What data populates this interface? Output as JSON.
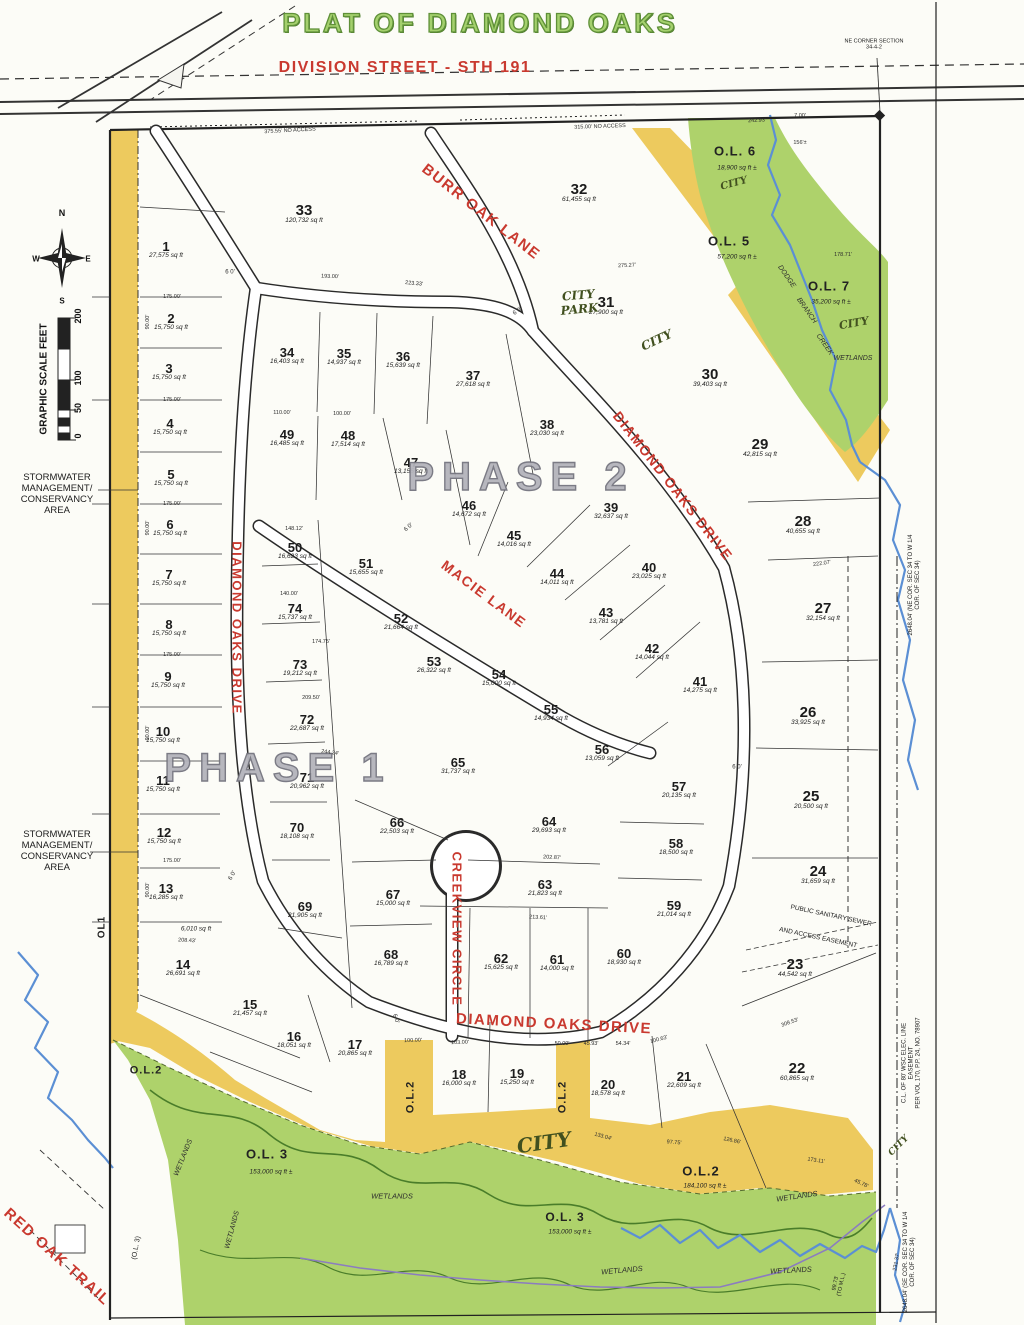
{
  "title": "PLAT OF DIAMOND OAKS",
  "colors": {
    "road_band_yellow": "#edca5e",
    "wetland_green": "#aed26b",
    "street_red": "#c9392f",
    "title_green": "#a4d06d",
    "creek_blue": "#5b8fd4",
    "easement_purple": "#8b7cc0",
    "phase_gray": "#9a9aa2"
  },
  "lots": [
    {
      "n": "1",
      "sf": "27,575 sq ft",
      "x": 166,
      "y": 250
    },
    {
      "n": "2",
      "sf": "15,750 sq ft",
      "x": 171,
      "y": 322
    },
    {
      "n": "3",
      "sf": "15,750 sq ft",
      "x": 169,
      "y": 372
    },
    {
      "n": "4",
      "sf": "15,750 sq ft",
      "x": 170,
      "y": 427
    },
    {
      "n": "5",
      "sf": "15,750 sq ft",
      "x": 171,
      "y": 478
    },
    {
      "n": "6",
      "sf": "15,750 sq ft",
      "x": 170,
      "y": 528
    },
    {
      "n": "7",
      "sf": "15,750 sq ft",
      "x": 169,
      "y": 578
    },
    {
      "n": "8",
      "sf": "15,750 sq ft",
      "x": 169,
      "y": 628
    },
    {
      "n": "9",
      "sf": "15,750 sq ft",
      "x": 168,
      "y": 680
    },
    {
      "n": "10",
      "sf": "15,750 sq ft",
      "x": 163,
      "y": 735
    },
    {
      "n": "11",
      "sf": "15,750 sq ft",
      "x": 163,
      "y": 784
    },
    {
      "n": "12",
      "sf": "15,750 sq ft",
      "x": 164,
      "y": 836
    },
    {
      "n": "13",
      "sf": "16,285 sq ft",
      "x": 166,
      "y": 892
    },
    {
      "n": "14",
      "sf": "26,691 sq ft",
      "x": 183,
      "y": 968
    },
    {
      "n": "15",
      "sf": "21,457 sq ft",
      "x": 250,
      "y": 1008
    },
    {
      "n": "16",
      "sf": "18,051 sq ft",
      "x": 294,
      "y": 1040
    },
    {
      "n": "17",
      "sf": "20,865 sq ft",
      "x": 355,
      "y": 1048
    },
    {
      "n": "18",
      "sf": "16,000 sq ft",
      "x": 459,
      "y": 1078
    },
    {
      "n": "19",
      "sf": "15,250 sq ft",
      "x": 517,
      "y": 1077
    },
    {
      "n": "20",
      "sf": "18,578 sq ft",
      "x": 608,
      "y": 1088
    },
    {
      "n": "21",
      "sf": "22,609 sq ft",
      "x": 684,
      "y": 1080
    },
    {
      "n": "22",
      "sf": "60,865 sq ft",
      "x": 797,
      "y": 1072,
      "b": 1
    },
    {
      "n": "23",
      "sf": "44,542 sq ft",
      "x": 795,
      "y": 968,
      "b": 1
    },
    {
      "n": "24",
      "sf": "31,659 sq ft",
      "x": 818,
      "y": 875,
      "b": 1
    },
    {
      "n": "25",
      "sf": "20,500 sq ft",
      "x": 811,
      "y": 800,
      "b": 1
    },
    {
      "n": "26",
      "sf": "33,925 sq ft",
      "x": 808,
      "y": 716,
      "b": 1
    },
    {
      "n": "27",
      "sf": "32,154 sq ft",
      "x": 823,
      "y": 612,
      "b": 1
    },
    {
      "n": "28",
      "sf": "40,655 sq ft",
      "x": 803,
      "y": 525,
      "b": 1
    },
    {
      "n": "29",
      "sf": "42,815 sq ft",
      "x": 760,
      "y": 448,
      "b": 1
    },
    {
      "n": "30",
      "sf": "39,403 sq ft",
      "x": 710,
      "y": 378,
      "b": 1
    },
    {
      "n": "31",
      "sf": "27,900 sq ft",
      "x": 606,
      "y": 306,
      "b": 1
    },
    {
      "n": "32",
      "sf": "61,455 sq ft",
      "x": 579,
      "y": 193,
      "b": 1
    },
    {
      "n": "33",
      "sf": "120,732 sq ft",
      "x": 304,
      "y": 214,
      "b": 1
    },
    {
      "n": "34",
      "sf": "16,403 sq ft",
      "x": 287,
      "y": 356
    },
    {
      "n": "35",
      "sf": "14,937 sq ft",
      "x": 344,
      "y": 357
    },
    {
      "n": "36",
      "sf": "15,639 sq ft",
      "x": 403,
      "y": 360
    },
    {
      "n": "37",
      "sf": "27,618 sq ft",
      "x": 473,
      "y": 379
    },
    {
      "n": "38",
      "sf": "23,030 sq ft",
      "x": 547,
      "y": 428
    },
    {
      "n": "39",
      "sf": "32,637 sq ft",
      "x": 611,
      "y": 511
    },
    {
      "n": "40",
      "sf": "23,025 sq ft",
      "x": 649,
      "y": 571
    },
    {
      "n": "41",
      "sf": "14,275 sq ft",
      "x": 700,
      "y": 685
    },
    {
      "n": "42",
      "sf": "14,044 sq ft",
      "x": 652,
      "y": 652
    },
    {
      "n": "43",
      "sf": "13,781 sq ft",
      "x": 606,
      "y": 616
    },
    {
      "n": "44",
      "sf": "14,011 sq ft",
      "x": 557,
      "y": 577
    },
    {
      "n": "45",
      "sf": "14,016 sq ft",
      "x": 514,
      "y": 539
    },
    {
      "n": "46",
      "sf": "14,672 sq ft",
      "x": 469,
      "y": 509
    },
    {
      "n": "47",
      "sf": "13,155 sq ft",
      "x": 411,
      "y": 466
    },
    {
      "n": "48",
      "sf": "17,514 sq ft",
      "x": 348,
      "y": 439
    },
    {
      "n": "49",
      "sf": "16,485 sq ft",
      "x": 287,
      "y": 438
    },
    {
      "n": "50",
      "sf": "16,623 sq ft",
      "x": 295,
      "y": 551
    },
    {
      "n": "51",
      "sf": "15,655 sq ft",
      "x": 366,
      "y": 567
    },
    {
      "n": "52",
      "sf": "21,664 sq ft",
      "x": 401,
      "y": 622
    },
    {
      "n": "53",
      "sf": "26,322 sq ft",
      "x": 434,
      "y": 665
    },
    {
      "n": "54",
      "sf": "15,000 sq ft",
      "x": 499,
      "y": 678
    },
    {
      "n": "55",
      "sf": "14,934 sq ft",
      "x": 551,
      "y": 713
    },
    {
      "n": "56",
      "sf": "13,059 sq ft",
      "x": 602,
      "y": 753
    },
    {
      "n": "57",
      "sf": "20,135 sq ft",
      "x": 679,
      "y": 790
    },
    {
      "n": "58",
      "sf": "18,500 sq ft",
      "x": 676,
      "y": 847
    },
    {
      "n": "59",
      "sf": "21,014 sq ft",
      "x": 674,
      "y": 909
    },
    {
      "n": "60",
      "sf": "18,930 sq ft",
      "x": 624,
      "y": 957
    },
    {
      "n": "61",
      "sf": "14,000 sq ft",
      "x": 557,
      "y": 963
    },
    {
      "n": "62",
      "sf": "15,625 sq ft",
      "x": 501,
      "y": 962
    },
    {
      "n": "63",
      "sf": "21,823 sq ft",
      "x": 545,
      "y": 888
    },
    {
      "n": "64",
      "sf": "29,693 sq ft",
      "x": 549,
      "y": 825
    },
    {
      "n": "65",
      "sf": "31,737 sq ft",
      "x": 458,
      "y": 766
    },
    {
      "n": "66",
      "sf": "22,503 sq ft",
      "x": 397,
      "y": 826
    },
    {
      "n": "67",
      "sf": "15,000 sq ft",
      "x": 393,
      "y": 898
    },
    {
      "n": "68",
      "sf": "16,789 sq ft",
      "x": 391,
      "y": 958
    },
    {
      "n": "69",
      "sf": "21,905 sq ft",
      "x": 305,
      "y": 910
    },
    {
      "n": "70",
      "sf": "18,108 sq ft",
      "x": 297,
      "y": 831
    },
    {
      "n": "71",
      "sf": "20,962 sq ft",
      "x": 307,
      "y": 781
    },
    {
      "n": "72",
      "sf": "22,687 sq ft",
      "x": 307,
      "y": 723
    },
    {
      "n": "73",
      "sf": "19,212 sq ft",
      "x": 300,
      "y": 668
    },
    {
      "n": "74",
      "sf": "15,737 sq ft",
      "x": 295,
      "y": 612
    }
  ],
  "labels": [
    {
      "t": "DIVISION STREET - STH 191",
      "x": 405,
      "y": 68,
      "r": 0,
      "s": 16,
      "c": "st"
    },
    {
      "t": "BURR OAK LANE",
      "x": 481,
      "y": 212,
      "r": 38,
      "s": 15,
      "c": "st"
    },
    {
      "t": "DIAMOND OAKS DRIVE",
      "x": 673,
      "y": 486,
      "r": 52,
      "s": 14,
      "c": "st"
    },
    {
      "t": "MACIE LANE",
      "x": 484,
      "y": 594,
      "r": 37,
      "s": 14,
      "c": "st"
    },
    {
      "t": "DIAMOND OAKS DRIVE",
      "x": 236,
      "y": 628,
      "r": 90,
      "s": 13,
      "c": "st"
    },
    {
      "t": "CREEKVIEW CIRCLE",
      "x": 456,
      "y": 929,
      "r": 90,
      "s": 13,
      "c": "st"
    },
    {
      "t": "DIAMOND OAKS DRIVE",
      "x": 554,
      "y": 1024,
      "r": 3,
      "s": 15,
      "c": "st"
    },
    {
      "t": "RED OAK TRAIL",
      "x": 57,
      "y": 1257,
      "r": 42,
      "s": 15,
      "c": "st"
    },
    {
      "t": "O.L. 6",
      "x": 735,
      "y": 152,
      "r": 0,
      "s": 13,
      "c": "ol"
    },
    {
      "t": "18,900 sq ft ±",
      "x": 737,
      "y": 168,
      "r": 0,
      "s": 6.5,
      "c": "olsf"
    },
    {
      "t": "O.L. 5",
      "x": 729,
      "y": 242,
      "r": 0,
      "s": 13,
      "c": "ol"
    },
    {
      "t": "57,200 sq ft ±",
      "x": 737,
      "y": 257,
      "r": 0,
      "s": 6.5,
      "c": "olsf"
    },
    {
      "t": "O.L. 7",
      "x": 829,
      "y": 287,
      "r": 0,
      "s": 13,
      "c": "ol"
    },
    {
      "t": "35,200 sq ft ±",
      "x": 831,
      "y": 302,
      "r": 0,
      "s": 6.5,
      "c": "olsf"
    },
    {
      "t": "O.L.2",
      "x": 146,
      "y": 1071,
      "r": 0,
      "s": 11,
      "c": "ol"
    },
    {
      "t": "O.L.2",
      "x": 411,
      "y": 1097,
      "r": -90,
      "s": 11,
      "c": "ol"
    },
    {
      "t": "O.L.2",
      "x": 563,
      "y": 1097,
      "r": -90,
      "s": 11,
      "c": "ol"
    },
    {
      "t": "O.L.2",
      "x": 701,
      "y": 1172,
      "r": 0,
      "s": 13,
      "c": "ol"
    },
    {
      "t": "184,100 sq ft ±",
      "x": 705,
      "y": 1186,
      "r": 0,
      "s": 6.5,
      "c": "olsf"
    },
    {
      "t": "O.L. 3",
      "x": 267,
      "y": 1155,
      "r": 0,
      "s": 13,
      "c": "ol"
    },
    {
      "t": "153,000 sq ft ±",
      "x": 271,
      "y": 1172,
      "r": 0,
      "s": 6.5,
      "c": "olsf"
    },
    {
      "t": "O.L. 3",
      "x": 565,
      "y": 1218,
      "r": 0,
      "s": 12,
      "c": "ol"
    },
    {
      "t": "153,000 sq ft ±",
      "x": 570,
      "y": 1232,
      "r": 0,
      "s": 6.5,
      "c": "olsf"
    },
    {
      "t": "OL1",
      "x": 102,
      "y": 927,
      "r": -90,
      "s": 10,
      "c": "ol"
    },
    {
      "t": "(O.L. 3)",
      "x": 137,
      "y": 1248,
      "r": -80,
      "s": 7,
      "c": "note"
    },
    {
      "t": "PHASE 1",
      "x": 278,
      "y": 768,
      "r": 0,
      "s": 40,
      "c": "ph"
    },
    {
      "t": "PHASE 2",
      "x": 521,
      "y": 477,
      "r": 0,
      "s": 40,
      "c": "ph"
    },
    {
      "t": "STORMWATER\nMANAGEMENT/\nCONSERVANCY\nAREA",
      "x": 57,
      "y": 495,
      "r": 0,
      "s": 9.5,
      "c": "note"
    },
    {
      "t": "STORMWATER\nMANAGEMENT/\nCONSERVANCY\nAREA",
      "x": 57,
      "y": 852,
      "r": 0,
      "s": 9.5,
      "c": "note"
    },
    {
      "t": "N",
      "x": 62,
      "y": 213,
      "r": 0,
      "s": 9,
      "c": "cmp"
    },
    {
      "t": "E",
      "x": 88,
      "y": 259,
      "r": 0,
      "s": 8,
      "c": "cmp"
    },
    {
      "t": "S",
      "x": 62,
      "y": 301,
      "r": 0,
      "s": 8,
      "c": "cmp"
    },
    {
      "t": "W",
      "x": 36,
      "y": 259,
      "r": 0,
      "s": 8,
      "c": "cmp"
    },
    {
      "t": "GRAPHIC SCALE FEET",
      "x": 44,
      "y": 379,
      "r": -90,
      "s": 10,
      "c": "scl"
    },
    {
      "t": "200",
      "x": 78,
      "y": 316,
      "r": -90,
      "s": 9,
      "c": "scl"
    },
    {
      "t": "100",
      "x": 78,
      "y": 378,
      "r": -90,
      "s": 9,
      "c": "scl"
    },
    {
      "t": "50",
      "x": 78,
      "y": 408,
      "r": -90,
      "s": 9,
      "c": "scl"
    },
    {
      "t": "0",
      "x": 78,
      "y": 436,
      "r": -90,
      "s": 9,
      "c": "scl"
    },
    {
      "t": "CITY\nPARK",
      "x": 579,
      "y": 303,
      "r": -5,
      "s": 12,
      "c": "hand"
    },
    {
      "t": "CITY",
      "x": 657,
      "y": 341,
      "r": -25,
      "s": 12,
      "c": "hand"
    },
    {
      "t": "CITY",
      "x": 734,
      "y": 184,
      "r": -15,
      "s": 10,
      "c": "hand"
    },
    {
      "t": "CITY",
      "x": 854,
      "y": 324,
      "r": -10,
      "s": 11,
      "c": "hand"
    },
    {
      "t": "CITY",
      "x": 544,
      "y": 1143,
      "r": -8,
      "s": 20,
      "c": "hand"
    },
    {
      "t": "CITY",
      "x": 899,
      "y": 1146,
      "r": -45,
      "s": 9,
      "c": "hand"
    },
    {
      "t": "WETLANDS",
      "x": 853,
      "y": 359,
      "r": 0,
      "s": 7,
      "c": "wet"
    },
    {
      "t": "WETLANDS",
      "x": 392,
      "y": 1197,
      "r": 0,
      "s": 7.5,
      "c": "wet"
    },
    {
      "t": "WETLANDS",
      "x": 797,
      "y": 1197,
      "r": -8,
      "s": 7.5,
      "c": "wet"
    },
    {
      "t": "WETLANDS",
      "x": 622,
      "y": 1271,
      "r": -5,
      "s": 7.5,
      "c": "wet"
    },
    {
      "t": "WETLANDS",
      "x": 791,
      "y": 1271,
      "r": -3,
      "s": 7.5,
      "c": "wet"
    },
    {
      "t": "WETLANDS",
      "x": 184,
      "y": 1158,
      "r": -68,
      "s": 7,
      "c": "wet"
    },
    {
      "t": "WETLANDS",
      "x": 233,
      "y": 1230,
      "r": -75,
      "s": 7,
      "c": "wet"
    },
    {
      "t": "DODGE",
      "x": 786,
      "y": 277,
      "r": 55,
      "s": 7,
      "c": "wet"
    },
    {
      "t": "BRANCH",
      "x": 806,
      "y": 311,
      "r": 55,
      "s": 7,
      "c": "wet"
    },
    {
      "t": "CREEK",
      "x": 824,
      "y": 345,
      "r": 55,
      "s": 7,
      "c": "wet"
    },
    {
      "t": "NE CORNER SECTION\n34-4-2",
      "x": 874,
      "y": 45,
      "r": 0,
      "s": 5.5,
      "c": "note"
    },
    {
      "t": "2648.04'  (NE COR. SEC 34 TO W 1/4\nCOR. OF SEC 34)",
      "x": 915,
      "y": 585,
      "r": -90,
      "s": 6,
      "c": "note"
    },
    {
      "t": "C.L. OF 80' WSC  ELEC. LINE EASEMENT\nPER VOL 170, P.P. 24, NO. 78907",
      "x": 912,
      "y": 1063,
      "r": -90,
      "s": 6,
      "c": "note"
    },
    {
      "t": "2648.04'  (SE COR. SEC 34 TO W 1/4\nCOR. OF SEC 34)",
      "x": 910,
      "y": 1262,
      "r": -90,
      "s": 6,
      "c": "note"
    },
    {
      "t": "99.73'\n(TO M.L.)",
      "x": 839,
      "y": 1284,
      "r": -78,
      "s": 5.5,
      "c": "note"
    },
    {
      "t": "PUBLIC SANITARY SEWER",
      "x": 831,
      "y": 916,
      "r": 12,
      "s": 6.5,
      "c": "note"
    },
    {
      "t": "AND ACCESS EASEMENT",
      "x": 818,
      "y": 938,
      "r": 12,
      "s": 6.5,
      "c": "note"
    },
    {
      "t": "6,010 sq ft",
      "x": 196,
      "y": 929,
      "r": 0,
      "s": 6.5,
      "c": "olsf"
    },
    {
      "t": "375.55'  NO ACCESS",
      "x": 290,
      "y": 131,
      "r": -3,
      "s": 5.5,
      "c": "dim"
    },
    {
      "t": "315.00'  NO ACCESS",
      "x": 600,
      "y": 127,
      "r": -2,
      "s": 5.5,
      "c": "dim"
    },
    {
      "t": "242.93'",
      "x": 757,
      "y": 121,
      "r": -3,
      "s": 5.5,
      "c": "dim"
    },
    {
      "t": "7.00'",
      "x": 800,
      "y": 116,
      "r": 0,
      "s": 5.5,
      "c": "dim"
    },
    {
      "t": "156'±",
      "x": 800,
      "y": 143,
      "r": 0,
      "s": 5.5,
      "c": "dim"
    },
    {
      "t": "178.71'",
      "x": 843,
      "y": 255,
      "r": 0,
      "s": 5.5,
      "c": "dim"
    },
    {
      "t": "193.00'",
      "x": 330,
      "y": 277,
      "r": 2,
      "s": 5.5,
      "c": "dim"
    },
    {
      "t": "223.33'",
      "x": 414,
      "y": 284,
      "r": 5,
      "s": 5.5,
      "c": "dim"
    },
    {
      "t": "275.27'",
      "x": 627,
      "y": 266,
      "r": -3,
      "s": 5.5,
      "c": "dim"
    },
    {
      "t": "175.00'",
      "x": 172,
      "y": 297,
      "r": 0,
      "s": 5.5,
      "c": "dim"
    },
    {
      "t": "175.00'",
      "x": 172,
      "y": 400,
      "r": 0,
      "s": 5.5,
      "c": "dim"
    },
    {
      "t": "175.00'",
      "x": 172,
      "y": 504,
      "r": 0,
      "s": 5.5,
      "c": "dim"
    },
    {
      "t": "175.00'",
      "x": 172,
      "y": 655,
      "r": 0,
      "s": 5.5,
      "c": "dim"
    },
    {
      "t": "175.00'",
      "x": 172,
      "y": 861,
      "r": 0,
      "s": 5.5,
      "c": "dim"
    },
    {
      "t": "90.00'",
      "x": 148,
      "y": 322,
      "r": -90,
      "s": 5.5,
      "c": "dim"
    },
    {
      "t": "90.00'",
      "x": 148,
      "y": 528,
      "r": -90,
      "s": 5.5,
      "c": "dim"
    },
    {
      "t": "90.00'",
      "x": 148,
      "y": 733,
      "r": -90,
      "s": 5.5,
      "c": "dim"
    },
    {
      "t": "90.00'",
      "x": 148,
      "y": 890,
      "r": -90,
      "s": 5.5,
      "c": "dim"
    },
    {
      "t": "110.00'",
      "x": 282,
      "y": 413,
      "r": 0,
      "s": 5.5,
      "c": "dim"
    },
    {
      "t": "100.00'",
      "x": 342,
      "y": 414,
      "r": 0,
      "s": 5.5,
      "c": "dim"
    },
    {
      "t": "148.12'",
      "x": 294,
      "y": 529,
      "r": 0,
      "s": 5.5,
      "c": "dim"
    },
    {
      "t": "140.00'",
      "x": 289,
      "y": 594,
      "r": 0,
      "s": 5.5,
      "c": "dim"
    },
    {
      "t": "174.75'",
      "x": 321,
      "y": 642,
      "r": 0,
      "s": 5.5,
      "c": "dim"
    },
    {
      "t": "209.50'",
      "x": 311,
      "y": 698,
      "r": 0,
      "s": 5.5,
      "c": "dim"
    },
    {
      "t": "244.24'",
      "x": 330,
      "y": 753,
      "r": 8,
      "s": 5.5,
      "c": "dim"
    },
    {
      "t": "208.43'",
      "x": 187,
      "y": 941,
      "r": 3,
      "s": 5.5,
      "c": "dim"
    },
    {
      "t": "202.87'",
      "x": 552,
      "y": 858,
      "r": 3,
      "s": 5.5,
      "c": "dim"
    },
    {
      "t": "213.61'",
      "x": 538,
      "y": 918,
      "r": 3,
      "s": 5.5,
      "c": "dim"
    },
    {
      "t": "103.00'",
      "x": 460,
      "y": 1043,
      "r": -2,
      "s": 5.5,
      "c": "dim"
    },
    {
      "t": "100.00'",
      "x": 413,
      "y": 1041,
      "r": -2,
      "s": 5.5,
      "c": "dim"
    },
    {
      "t": "50.00'",
      "x": 562,
      "y": 1044,
      "r": 0,
      "s": 5.5,
      "c": "dim"
    },
    {
      "t": "45.93'",
      "x": 591,
      "y": 1044,
      "r": 0,
      "s": 5.5,
      "c": "dim"
    },
    {
      "t": "54.34'",
      "x": 623,
      "y": 1044,
      "r": 0,
      "s": 5.5,
      "c": "dim"
    },
    {
      "t": "100.63'",
      "x": 659,
      "y": 1040,
      "r": -15,
      "s": 5.5,
      "c": "dim"
    },
    {
      "t": "133.04'",
      "x": 603,
      "y": 1137,
      "r": 15,
      "s": 5.5,
      "c": "dim"
    },
    {
      "t": "97.75'",
      "x": 674,
      "y": 1143,
      "r": 5,
      "s": 5.5,
      "c": "dim"
    },
    {
      "t": "126.86'",
      "x": 732,
      "y": 1141,
      "r": 12,
      "s": 5.5,
      "c": "dim"
    },
    {
      "t": "173.11'",
      "x": 816,
      "y": 1161,
      "r": 8,
      "s": 5.5,
      "c": "dim"
    },
    {
      "t": "45.78'",
      "x": 861,
      "y": 1184,
      "r": 25,
      "s": 5.5,
      "c": "dim"
    },
    {
      "t": "308.53'",
      "x": 790,
      "y": 1023,
      "r": -20,
      "s": 5.5,
      "c": "dim"
    },
    {
      "t": "222.07'",
      "x": 822,
      "y": 564,
      "r": -8,
      "s": 5.5,
      "c": "dim"
    },
    {
      "t": "231.37'",
      "x": 897,
      "y": 1262,
      "r": -80,
      "s": 5.5,
      "c": "dim"
    },
    {
      "t": "6 0'",
      "x": 230,
      "y": 273,
      "r": 0,
      "s": 6,
      "c": "dim"
    },
    {
      "t": "6 0'",
      "x": 518,
      "y": 312,
      "r": -35,
      "s": 6,
      "c": "dim"
    },
    {
      "t": "6 0'",
      "x": 409,
      "y": 528,
      "r": -40,
      "s": 6,
      "c": "dim"
    },
    {
      "t": "6 0'",
      "x": 737,
      "y": 768,
      "r": 0,
      "s": 6,
      "c": "dim"
    },
    {
      "t": "6 0'",
      "x": 233,
      "y": 876,
      "r": -60,
      "s": 6,
      "c": "dim"
    },
    {
      "t": "6 0'",
      "x": 395,
      "y": 1019,
      "r": 70,
      "s": 6,
      "c": "dim"
    }
  ]
}
